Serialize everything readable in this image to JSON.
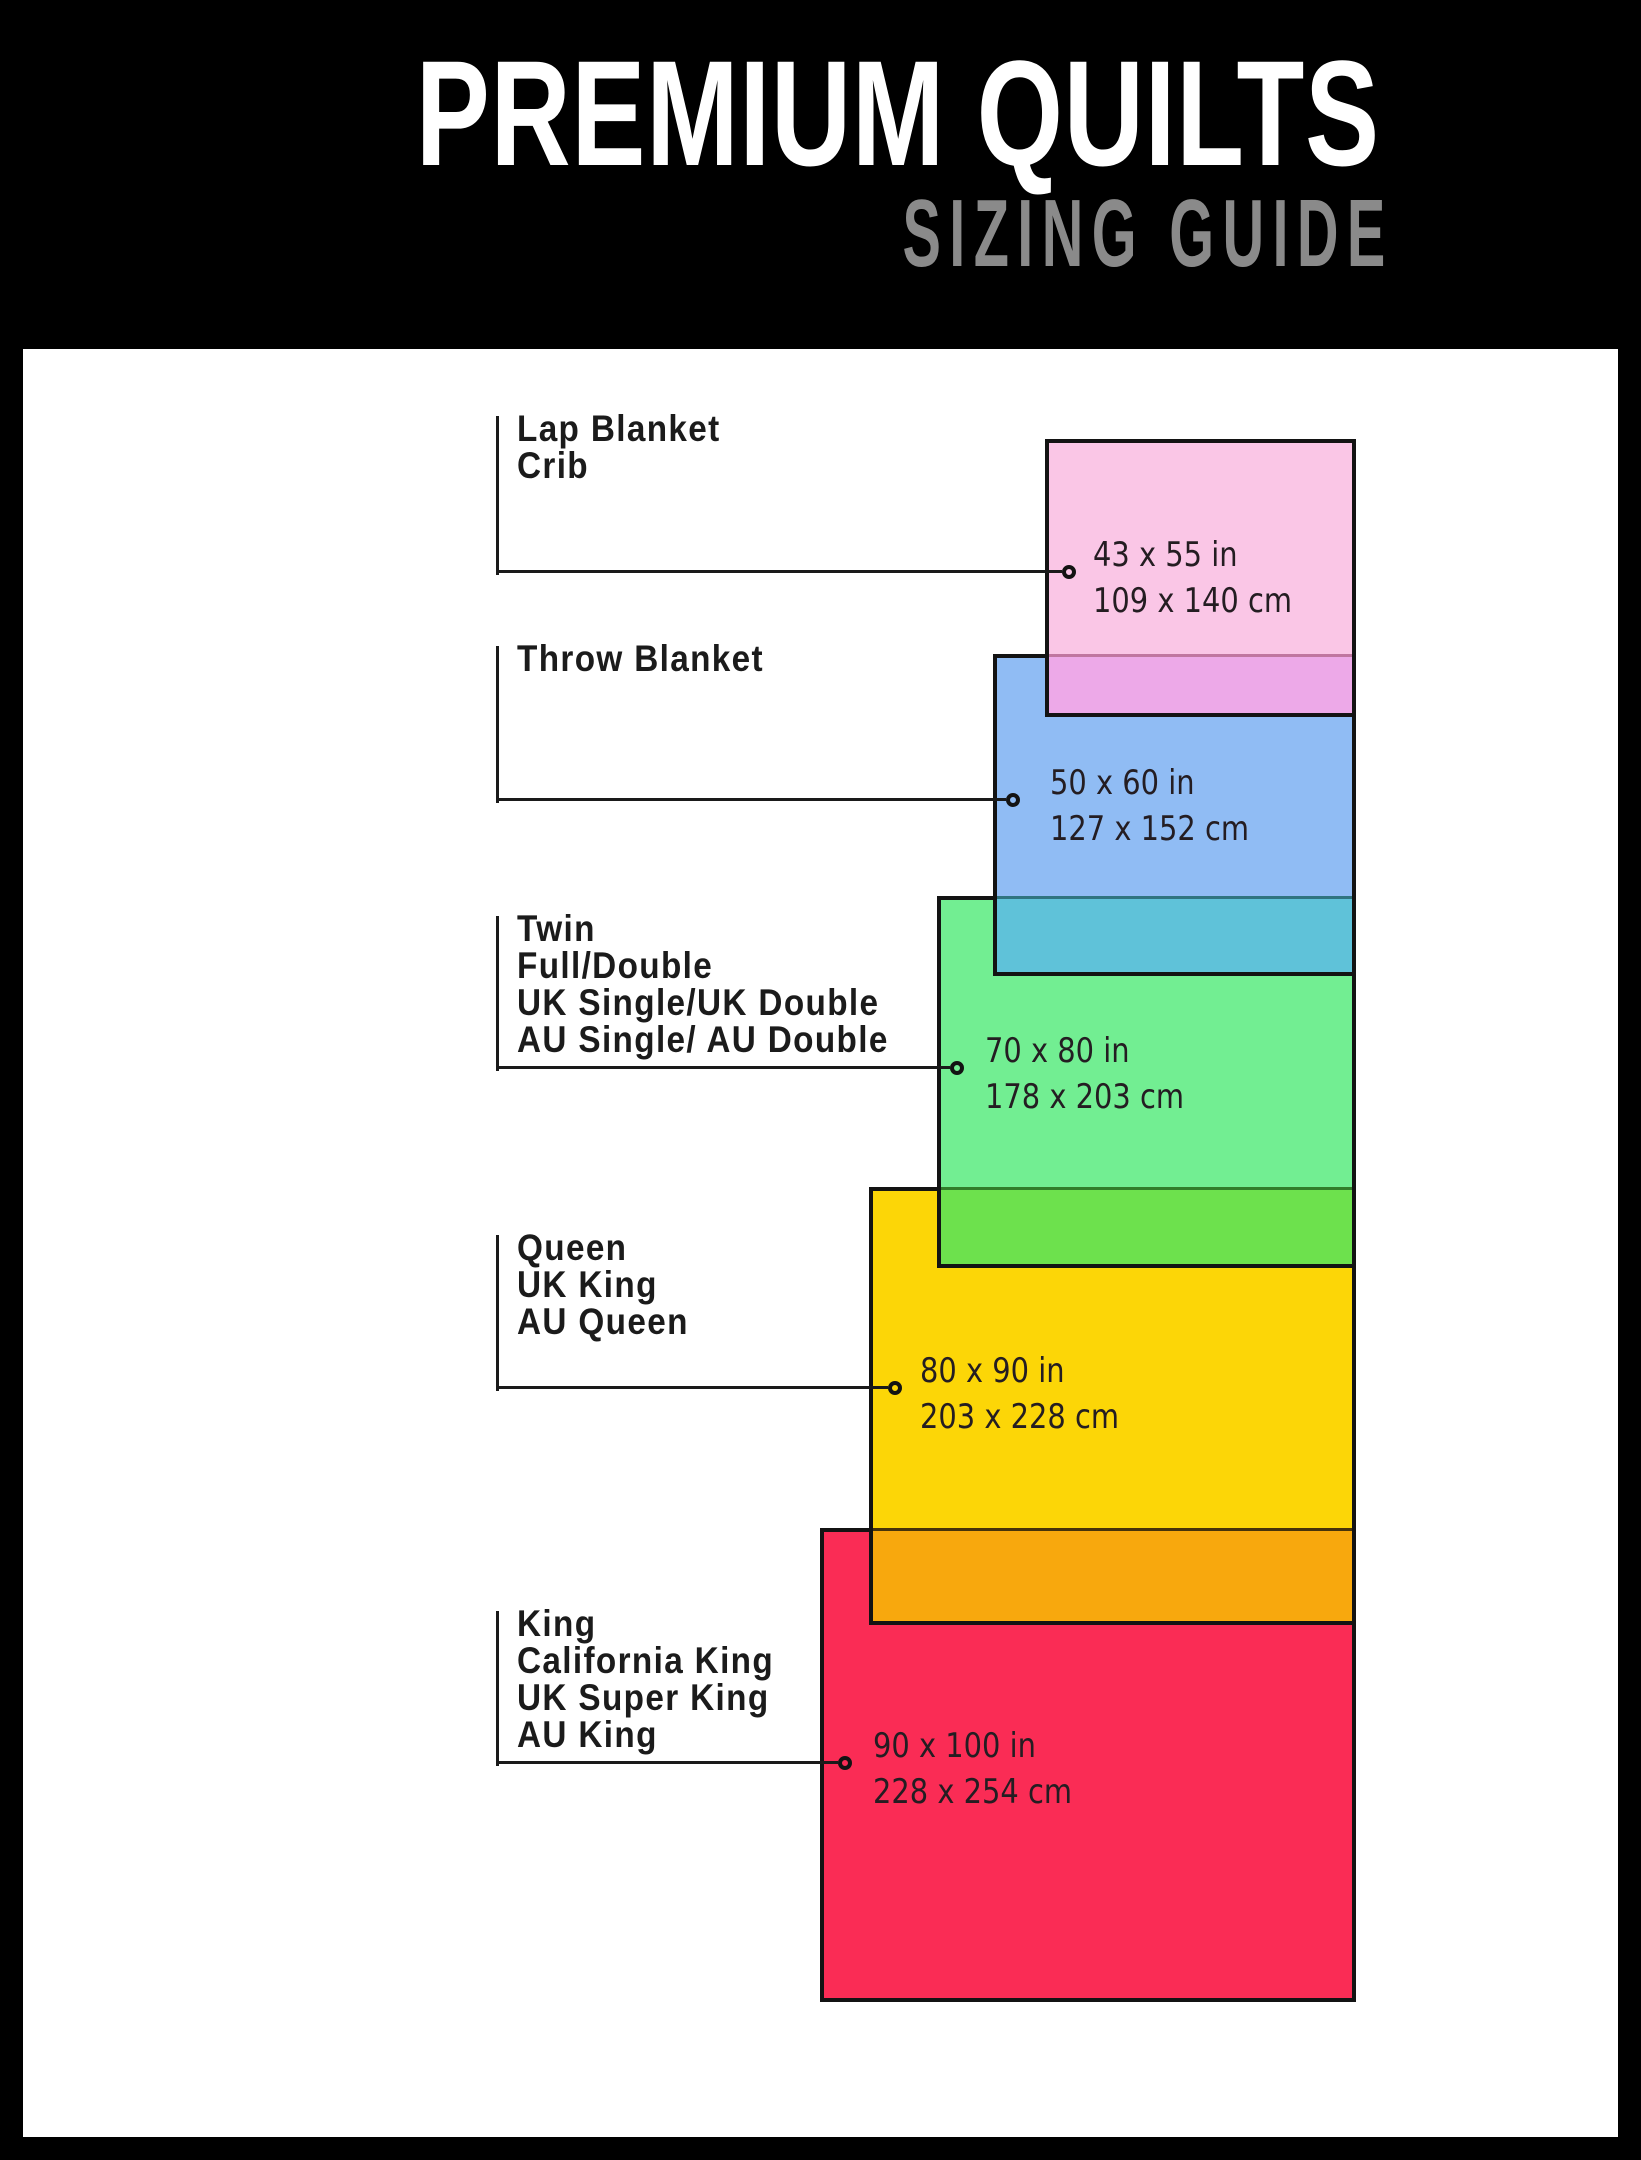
{
  "header": {
    "title": "PREMIUM QUILTS",
    "subtitle": "SIZING GUIDE",
    "background": "#000000",
    "title_color": "#ffffff",
    "subtitle_color": "#8a8a8a"
  },
  "frame": {
    "frame_color": "#000000",
    "content_background": "#ffffff",
    "rect_border_color": "#131313",
    "leader_line_color": "#1a1a1a"
  },
  "sizes": [
    {
      "id": "lap-blanket-crib",
      "labels": [
        "Lap Blanket",
        "Crib"
      ],
      "size_in": "43 x 55 in",
      "size_cm": "109 x 140 cm",
      "fill": "#FAC6E6",
      "overlap_fill": "",
      "overlap_line": ""
    },
    {
      "id": "throw-blanket",
      "labels": [
        "Throw Blanket"
      ],
      "size_in": "50 x 60 in",
      "size_cm": "127 x 152 cm",
      "fill": "#90BCF4",
      "overlap_fill": "#EDA9E8",
      "overlap_line": "#C076A0"
    },
    {
      "id": "twin-full-double",
      "labels": [
        "Twin",
        "Full/Double",
        "UK Single/UK Double",
        "AU Single/ AU Double"
      ],
      "size_in": "70 x 80 in",
      "size_cm": "178 x 203 cm",
      "fill": "#72EE92",
      "overlap_fill": "#5FC2D9",
      "overlap_line": "#2F7480"
    },
    {
      "id": "queen",
      "labels": [
        "Queen",
        "UK King",
        "AU Queen"
      ],
      "size_in": "80 x 90 in",
      "size_cm": "203 x 228 cm",
      "fill": "#FCD607",
      "overlap_fill": "#6DE14D",
      "overlap_line": "#317D2B"
    },
    {
      "id": "king",
      "labels": [
        "King",
        "California King",
        "UK Super King",
        "AU King"
      ],
      "size_in": "90 x 100 in",
      "size_cm": "228 x 254 cm",
      "fill": "#FA2C55",
      "overlap_fill": "#F8A80D",
      "overlap_line": "#47330A"
    }
  ]
}
